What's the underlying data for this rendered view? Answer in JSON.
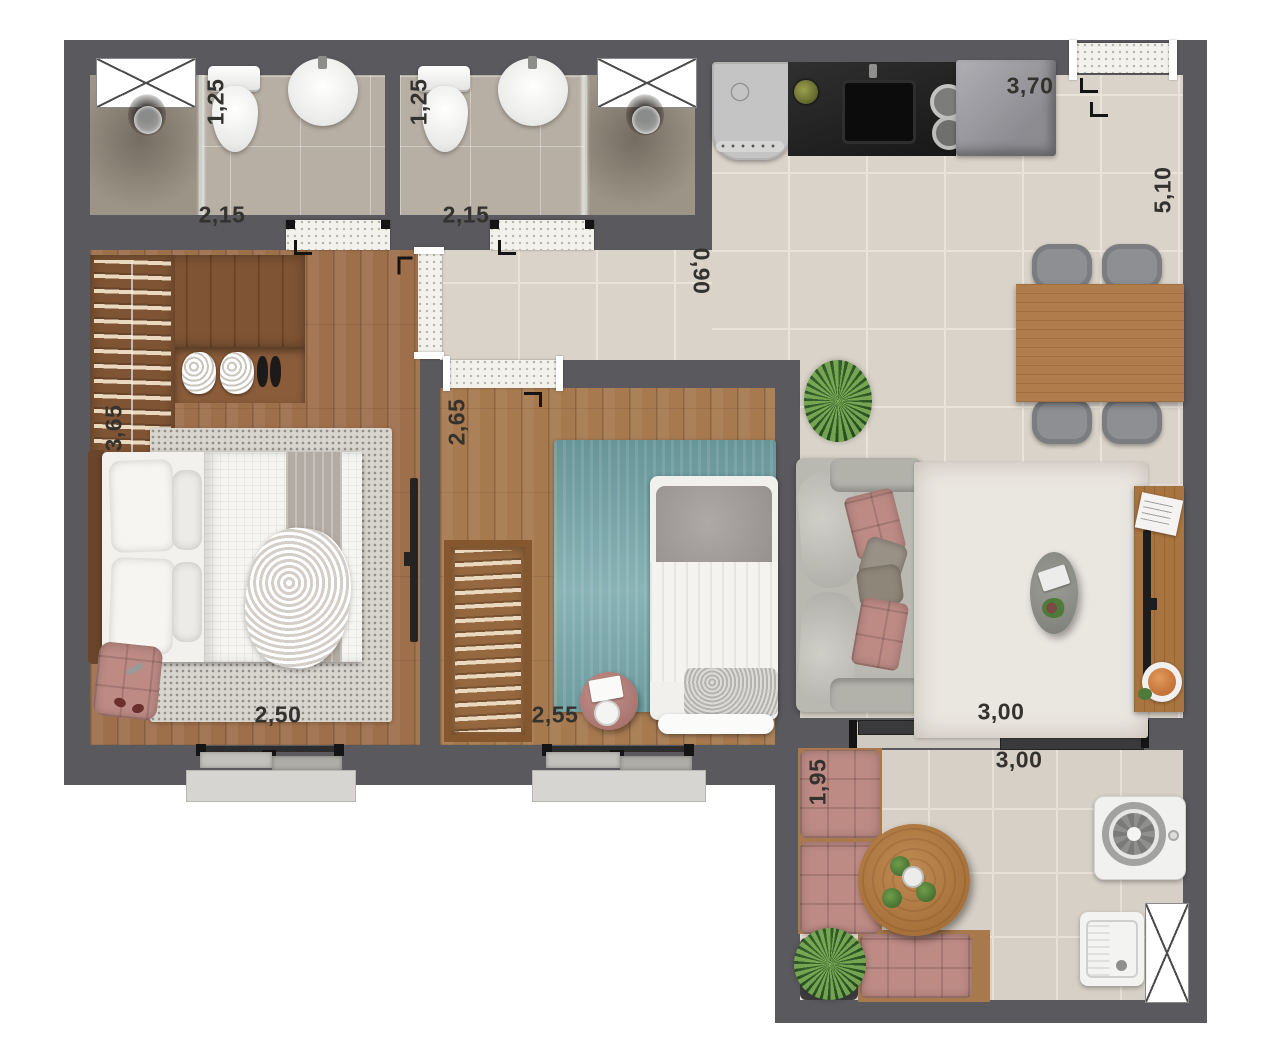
{
  "plan": {
    "bathroom1": {
      "width": "1,25",
      "length": "2,15"
    },
    "bathroom2": {
      "width": "1,25",
      "length": "2,15"
    },
    "kitchen": {
      "length": "3,70",
      "depth": "5,10"
    },
    "hall": {
      "width": "0,90"
    },
    "bedroom1": {
      "depth": "3,65",
      "width": "2,50"
    },
    "bedroom2": {
      "depth": "2,65",
      "width": "2,55"
    },
    "living": {
      "width": "3,00"
    },
    "balcony": {
      "width": "3,00",
      "depth": "1,95"
    }
  },
  "colors": {
    "wall": "#5a595d",
    "tile": "#d9d3c9",
    "bathfloor": "#b7afa4",
    "wood": "#9e6f4b",
    "teal": "#79a9ac",
    "pink": "#bd8a84"
  }
}
